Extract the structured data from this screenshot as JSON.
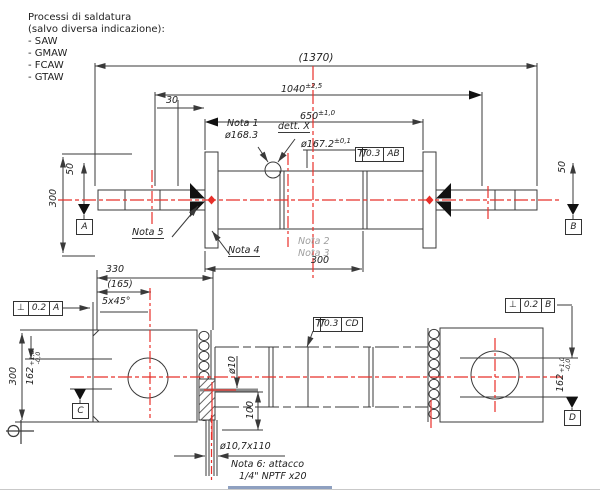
{
  "header": {
    "title": "Processi di saldatura",
    "subtitle": "(salvo diversa indicazione):",
    "items": [
      "- SAW",
      "- GMAW",
      "- FCAW",
      "- GTAW"
    ]
  },
  "top_view": {
    "dim_overall": "(1370)",
    "dim_1040": "1040",
    "dim_1040_tol": "±2,5",
    "dim_650": "650",
    "dim_650_tol": "±1,0",
    "dim_30": "30",
    "dim_300_flange": "300",
    "dim_50_left": "50",
    "dim_50_right": "50",
    "dim_300_mid": "300",
    "nota1": "Nota 1",
    "dia_168": "ø168.3",
    "dett_x": "dett. X",
    "dia_167": "ø167.2",
    "dia_167_tol": "±0,1",
    "fcf_runout": {
      "tol": "0.3",
      "datum": "AB"
    },
    "nota5": "Nota 5",
    "nota4": "Nota 4",
    "nota2": "Nota 2",
    "nota3": "Nota 3",
    "datum_a": "A",
    "datum_b": "B"
  },
  "bottom_view": {
    "dim_330": "330",
    "dim_165": "(165)",
    "chamfer": "5x45°",
    "fcf_perp_left": {
      "sym": "⊥",
      "tol": "0.2",
      "datum": "A"
    },
    "fcf_runout_mid": {
      "tol": "0.3",
      "datum": "CD"
    },
    "fcf_perp_right": {
      "sym": "⊥",
      "tol": "0.2",
      "datum": "B"
    },
    "dim_300": "300",
    "dim_162_left": {
      "base": "162",
      "tol_up": "+1,0",
      "tol_dn": "-0,0"
    },
    "dim_162_right": {
      "base": "162",
      "tol_up": "+1,0",
      "tol_dn": "-0,0"
    },
    "dia_10": "ø10",
    "dim_100": "100",
    "datum_c": "C",
    "datum_d": "D",
    "dia_107": "ø10,7x110",
    "nota6_line1": "Nota 6: attacco",
    "nota6_line2": "1/4\" NPTF x20"
  },
  "colors": {
    "line": "#3a3a3a",
    "centerline": "#e8302a",
    "note_gray": "#a0a0a0"
  }
}
